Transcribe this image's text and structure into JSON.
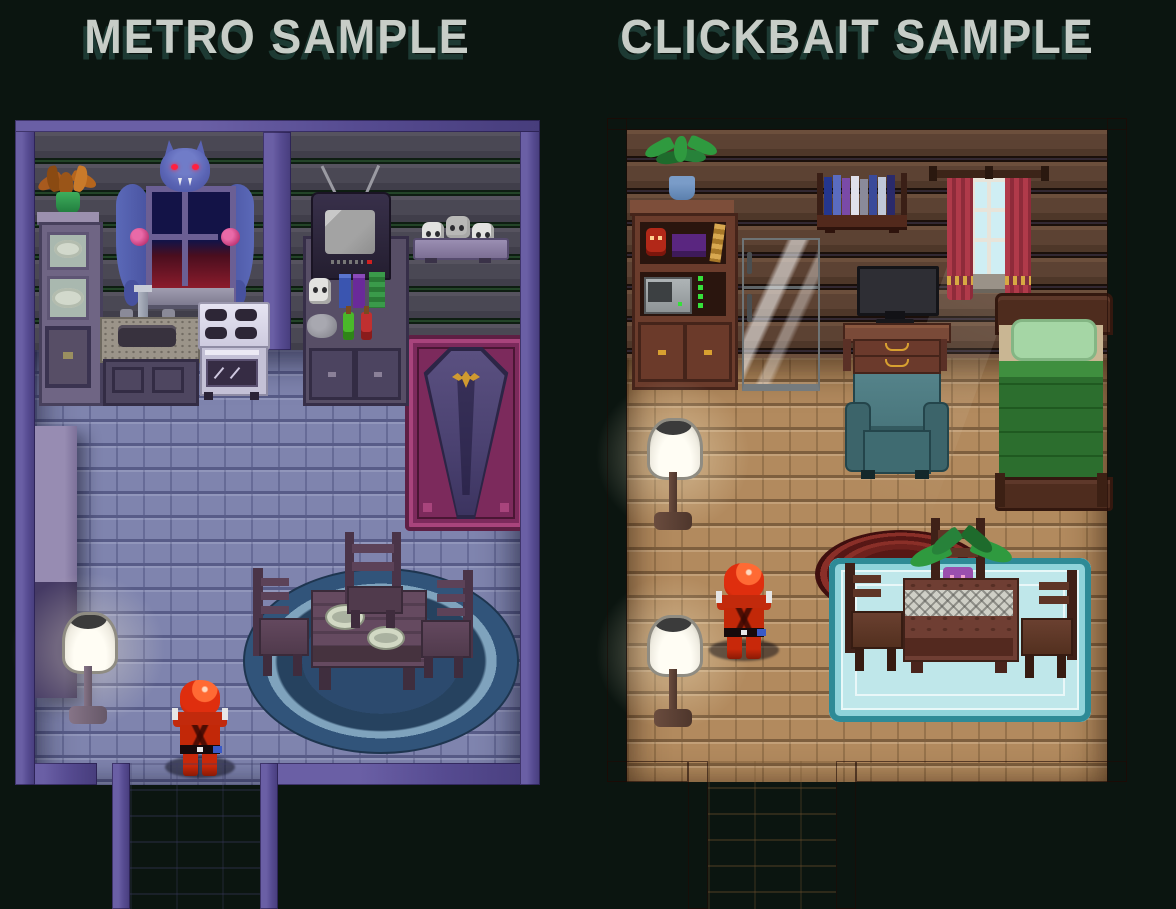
{
  "header": {
    "metro_title": "METRO SAMPLE",
    "clickbait_title": "CLICKBAIT SAMPLE",
    "title_color": "#c7cdc7",
    "title_shadow_color": "#1d3a33"
  },
  "colors": {
    "bg": "#0b1510",
    "title": "#c7cdc7",
    "titleShadow": "#1d3a33",
    "charRed": "#df2e0e",
    "metroBorder": "#564b91",
    "metroWall": "#4a4854",
    "metroFloor": "#7f84ae",
    "metroRug": "#2e4e72",
    "coffinRug": "#7c2a5c",
    "coffinBody": "#544a74",
    "emblemGold": "#d09a30",
    "clickbaitBorder": "#5e2c23",
    "clickbaitWall": "#5c4233",
    "clickbaitFloor": "#b28a5e",
    "tealRug": "#c2ebee",
    "tealRugEdge": "#2e8a96",
    "redRug": "#5e1b18",
    "armchairTeal": "#47747a",
    "bedBlanketGreen": "#2c6e2e",
    "bedPillowGreen": "#a5d6a5",
    "curtainRed": "#a83848",
    "lampShade": "#f4f1e8"
  },
  "rooms": {
    "metro": {
      "title": "METRO SAMPLE",
      "theme": "gothic-vampire-apartment",
      "items": [
        "dried-plant-stand",
        "dish-cabinet",
        "bat-curtain-window",
        "kitchen-sink",
        "stove",
        "crt-tv",
        "potion-shelf",
        "skull-shelf",
        "coffin",
        "coffin-rug",
        "round-blue-rug",
        "dining-table",
        "dinner-plates",
        "three-chairs",
        "floor-lamp",
        "wall-column",
        "player-character",
        "south-doorway"
      ]
    },
    "clickbait": {
      "title": "CLICKBAIT SAMPLE",
      "theme": "cozy-cabin-apartment",
      "items": [
        "potted-plant",
        "hutch-cabinet",
        "microwave",
        "refrigerator",
        "wall-book-shelf",
        "computer-desk",
        "monitor",
        "window-with-red-curtains",
        "bed",
        "armchair",
        "round-red-rug",
        "teal-rug",
        "dining-table",
        "table-plant",
        "three-chairs",
        "floor-lamp",
        "floor-lamp",
        "player-character",
        "south-doorway"
      ]
    }
  }
}
